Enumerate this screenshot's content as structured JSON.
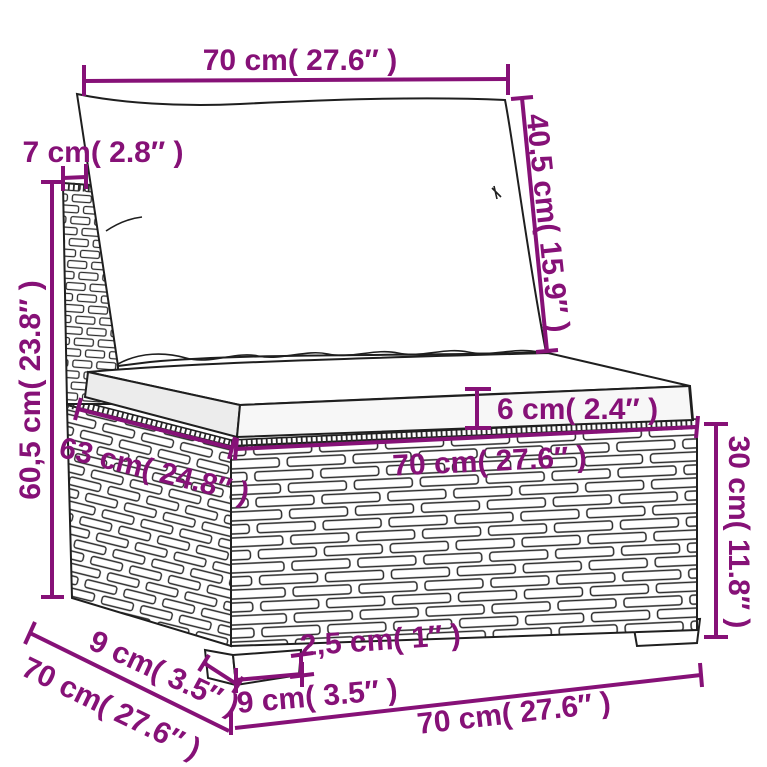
{
  "colors": {
    "dimension_accent": "#861177",
    "drawing_outline": "#1f1f1f",
    "cushion_fill": "#ffffff",
    "cushion_shade": "#f0f0f0"
  },
  "dimensions": {
    "back_cushion_width": "70 cm( 27.6″ )",
    "back_frame_thickness": "7 cm( 2.8″ )",
    "back_cushion_height": "40,5 cm( 15.9″ )",
    "total_back_height": "60,5 cm( 23.8″ )",
    "seat_cushion_thickness": "6 cm( 2.4″ )",
    "seat_depth": "63 cm( 24.8″ )",
    "seat_width": "70 cm( 27.6″ )",
    "base_height": "30 cm( 11.8″ )",
    "leg_depth": "9 cm( 3.5″ )",
    "total_depth": "70 cm( 27.6″ )",
    "leg_width": "9 cm( 3.5″ )",
    "foot_height": "2,5 cm( 1″ )",
    "total_width": "70 cm( 27.6″ )"
  }
}
